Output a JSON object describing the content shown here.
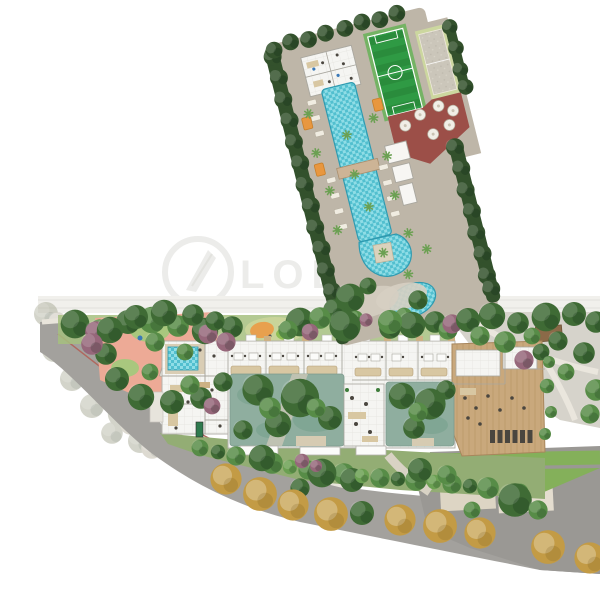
{
  "watermark": {
    "text": "LOB",
    "logo_icon": "quill-circle-icon"
  },
  "palette": {
    "background": "#ffffff",
    "field_green": "#2f9a44",
    "field_green_dark": "#2a8c3c",
    "field_margin": "#74b364",
    "court_frame": "#ccd79f",
    "court_sand": "#cbc6ba",
    "terrace_red": "#9c4f48",
    "pool_water": "#52bfcf",
    "pool_water_light": "#8fdde6",
    "pool_edge": "#2e9ab0",
    "deck_stone": "#beb6a8",
    "deck_light": "#d6cfc2",
    "hedge_dark": "#33512c",
    "tree_dark": "#3f6b35",
    "tree_mid": "#578c47",
    "tree_light": "#6ba052",
    "tree_red": "#96677a",
    "tree_gold": "#c39b45",
    "faded_tree_a": "#a9ab97",
    "faded_tree_b": "#bcb6a5",
    "grass": "#a6bf7f",
    "lawn": "#84b05a",
    "playground_pink": "#edaa96",
    "playground_green": "#a9c77e",
    "mini_playground_base": "#c9d49a",
    "accent_orange": "#e8a04e",
    "cabana_orange": "#e8973f",
    "building_floor": "#f5f5f2",
    "building_wall": "#9e9c96",
    "courtyard_water": "#8fae9f",
    "courtyard_blotch": "#7ba390",
    "wood_floor": "#c9a87c",
    "furniture_tan": "#d8c7a2",
    "furniture_dark": "#4a463f",
    "pool_table_green": "#2f7a4e",
    "road_gray": "#a3a19d",
    "parking_gray": "#9a9894",
    "plaza_beige": "#ddd5c4",
    "sidewalk": "#f1f0ec",
    "path_light": "#e3dfd6",
    "bike_lane_red": "#b0685f",
    "bridge_tan": "#cdb496",
    "spa_deck": "#d9cdb4",
    "watermark_gray": "#ececea"
  }
}
